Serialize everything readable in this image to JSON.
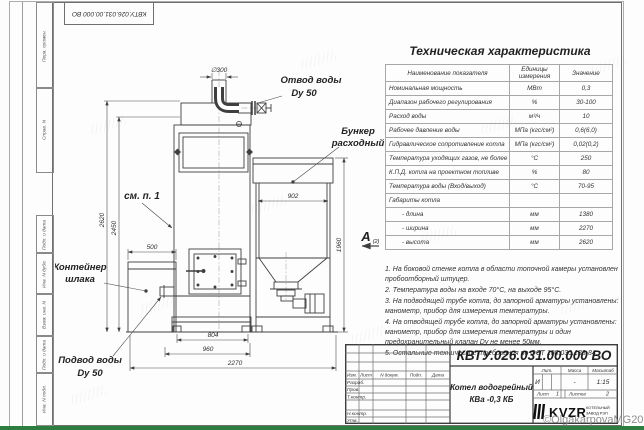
{
  "doc_number": "КВТУ.026.031.00.000  ВО",
  "watermark": "©OlgakarpovaMG2021",
  "colors": {
    "green_bar": "#2e7d40",
    "line": "#3f3f3f",
    "watermark_gray": "#8f8f8f"
  },
  "frame": {
    "left_top": [
      "Перв. примен.",
      "Справ. N"
    ],
    "left_bottom": [
      "Подп. и дата",
      "Инв. N дубл.",
      "Взам. инв. N",
      "Подп. и дата",
      "Инв. N подл."
    ]
  },
  "drawing": {
    "labels": {
      "outlet_1": "Отвод воды",
      "outlet_2": "Dy 50",
      "hopper_1": "Бункер",
      "hopper_2": "расходный",
      "see_note": "см. п. 1",
      "slag_1": "Контейнер",
      "slag_2": "шлака",
      "inlet_1": "Подвод воды",
      "inlet_2": "Dy 50",
      "view": "A",
      "view_sub": "(2)"
    },
    "dimensions": {
      "d300": "∅300",
      "v2620": "2620",
      "v2450": "2450",
      "w500": "500",
      "w902": "902",
      "w804": "804",
      "w960": "960",
      "w2270": "2270",
      "v1960": "1960"
    }
  },
  "spec_table": {
    "title": "Техническая характеристика",
    "headers": [
      "Наименование показателя",
      "Единицы измерения",
      "Значение"
    ],
    "rows": [
      [
        "Номинальная мощность",
        "МВт",
        "0,3"
      ],
      [
        "Диапазон рабочего регулирования",
        "%",
        "30-100"
      ],
      [
        "Расход воды",
        "м³/ч",
        "10"
      ],
      [
        "Рабочее давление воды",
        "МПа (кгс/см²)",
        "0,6(6,0)"
      ],
      [
        "Гидравлическое сопротивление котла",
        "МПа (кгс/см²)",
        "0,02(0,2)"
      ],
      [
        "Температура уходящих газов, не более",
        "°С",
        "250"
      ],
      [
        "К.П.Д. котла на проектном топливе",
        "%",
        "80"
      ],
      [
        "Температура воды (Вход/выход)",
        "°С",
        "70-95"
      ],
      [
        "Габариты котла",
        "",
        ""
      ],
      [
        "- длина",
        "мм",
        "1380"
      ],
      [
        "- ширина",
        "мм",
        "2270"
      ],
      [
        "- высота",
        "мм",
        "2620"
      ]
    ]
  },
  "notes": [
    "1.  На боковой стенке котла в области топочной камеры установлен пробоотборный штуцер.",
    "2.  Температура воды на входе  70°С,  на выходе  95°С.",
    "3.  На подводящей трубе котла, до запорной арматуры установлены: манометр, прибор для измерения температуры.",
    "4.  На отводящей трубе котла, до запорной арматуры установлены: манометр, прибор для измерения температуры и один предохранительный клапан Dy не менее  50мм.",
    "5.  Остальные технические требования по ОСТ  108.030.133-84."
  ],
  "title_block": {
    "header_cols": [
      "Изм.",
      "Лист",
      "N докум.",
      "Подп.",
      "Дата"
    ],
    "row_labels": [
      "Разраб.",
      "Пров.",
      "Т.контр.",
      "Н.контр.",
      "Утв."
    ],
    "product_line1": "Котел водогрейный",
    "product_line2": "КВа -0,3  КБ",
    "lit_label": "Лит.",
    "mass_label": "Масса",
    "scale_label": "Масштаб",
    "lit_value": "И",
    "mass_value": "-",
    "scale_value": "1:15",
    "sheet_label": "Лист",
    "sheet_value": "1",
    "sheets_label": "Листов",
    "sheets_value": "2",
    "company": "KVZR",
    "company_sub1": "КОТЕЛЬНЫЙ",
    "company_sub2": "ЗАВОД  РЭП"
  }
}
